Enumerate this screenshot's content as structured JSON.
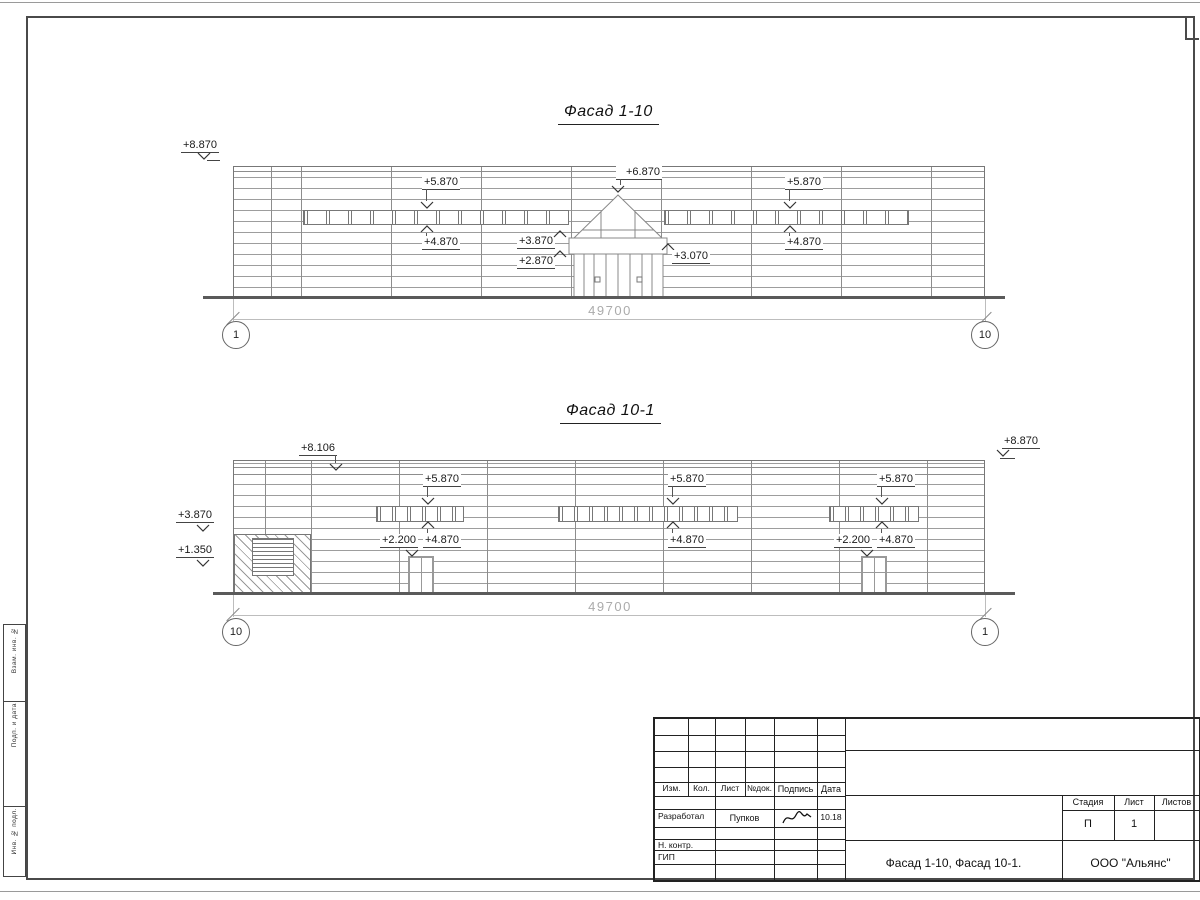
{
  "facade1": {
    "title": "Фасад 1-10",
    "dim": "49700",
    "axisL": "1",
    "axisR": "10",
    "mTop": "+8.870",
    "mBandL_top": "+5.870",
    "mBandL_bot": "+4.870",
    "mGable": "+6.870",
    "mCanopyTop": "+3.870",
    "mCanopyBot": "+2.870",
    "mCanopyR": "+3.070",
    "mBandR_top": "+5.870",
    "mBandR_bot": "+4.870"
  },
  "facade2": {
    "title": "Фасад 10-1",
    "dim": "49700",
    "axisL": "10",
    "axisR": "1",
    "mRoof": "+8.106",
    "mTopR": "+8.870",
    "mLeftUp": "+3.870",
    "mLeftLow": "+1.350",
    "b1_top": "+5.870",
    "b1_bot": "+4.870",
    "b1_door": "+2.200",
    "b2_top": "+5.870",
    "b2_bot": "+4.870",
    "b3_top": "+5.870",
    "b3_bot": "+4.870",
    "b3_door": "+2.200"
  },
  "titleblock": {
    "h_izm": "Изм.",
    "h_kol": "Кол.",
    "h_list": "Лист",
    "h_doc": "№док.",
    "h_sign": "Подпись",
    "h_date": "Дата",
    "r1_role": "Разработал",
    "r1_name": "Пупков",
    "r1_date": "10.18",
    "r2_role": "Н. контр.",
    "r3_role": "ГИП",
    "doc_title": "Фасад 1-10, Фасад 10-1.",
    "company": "ООО \"Альянс\"",
    "stage_h": "Стадия",
    "list_h": "Лист",
    "listov_h": "Листов",
    "stage": "П",
    "list_no": "1"
  },
  "side": {
    "s1": "Взам. инв. №",
    "s2": "Подп. и дата",
    "s3": "Инв. № подл."
  }
}
